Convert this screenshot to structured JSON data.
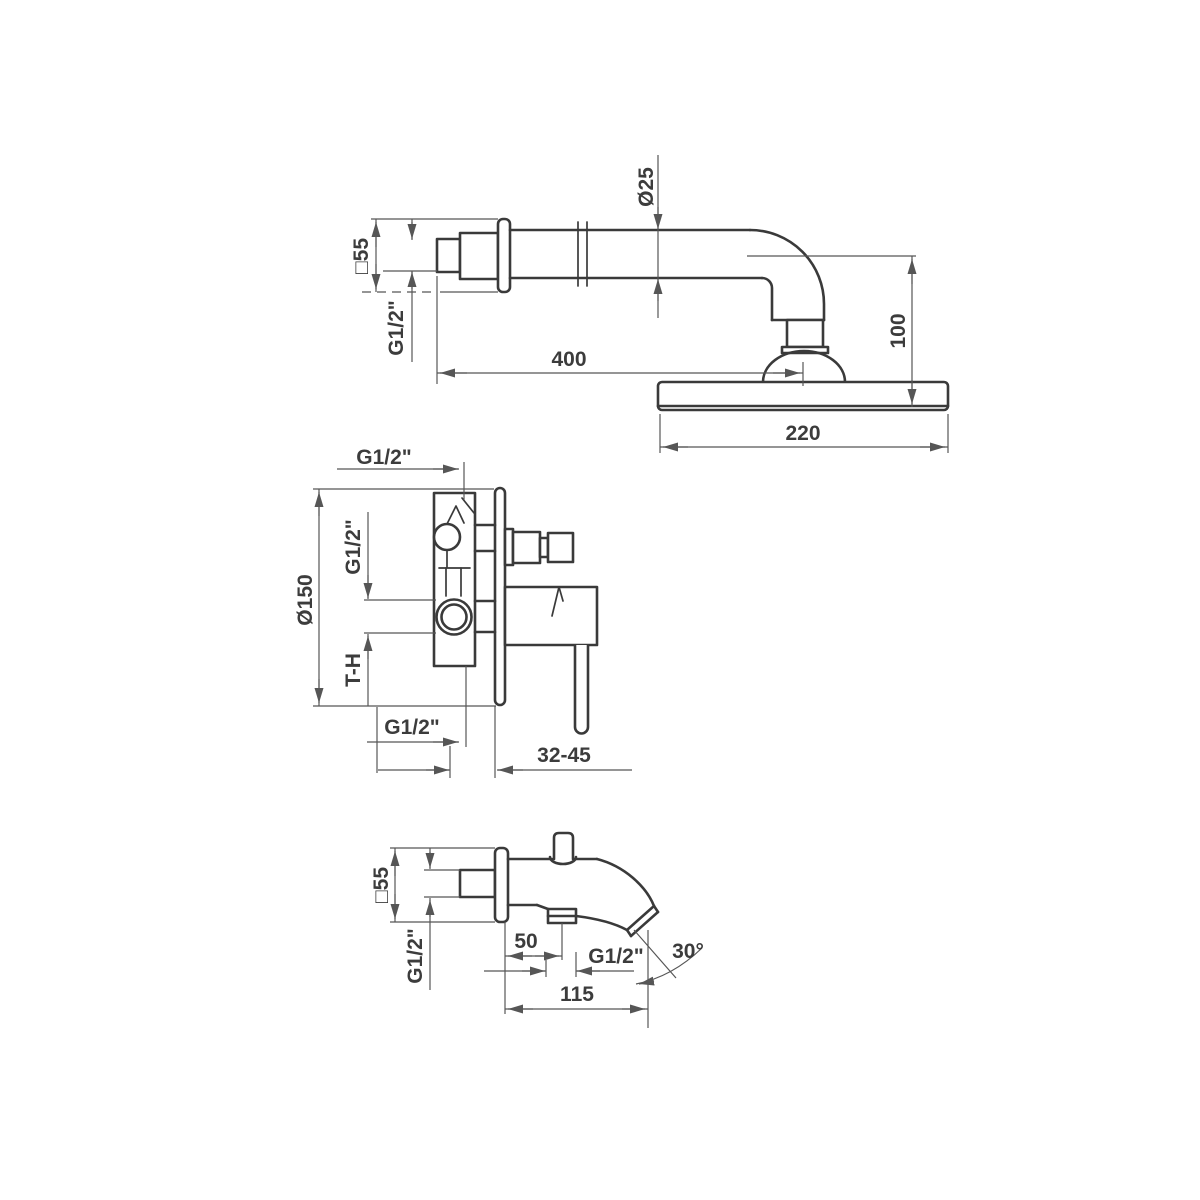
{
  "drawing": {
    "title": "faucet-set-technical-dimension-drawing",
    "colors": {
      "bg": "#ffffff",
      "outline": "#3a3a3a",
      "dim": "#565656",
      "text": "#3c3c3c"
    },
    "views": {
      "shower_arm": {
        "labels": {
          "pipe_diameter": "Ø25",
          "wall_plate": "□55",
          "wall_thread": "G1/2\"",
          "arm_length": "400",
          "head_height": "100",
          "head_width": "220"
        }
      },
      "mixer_valve": {
        "labels": {
          "top_outlet_thread": "G1/2\"",
          "plate_diameter": "Ø150",
          "inlet_thread": "G1/2\"",
          "inlet_marking": "T-H",
          "bottom_outlet_thread": "G1/2\"",
          "mounting_depth_range": "32-45"
        }
      },
      "spout": {
        "labels": {
          "wall_plate": "□55",
          "wall_thread": "G1/2\"",
          "outlet_offset": "50",
          "outlet_thread": "G1/2\"",
          "spout_length": "115",
          "outflow_angle": "30°"
        }
      }
    }
  }
}
